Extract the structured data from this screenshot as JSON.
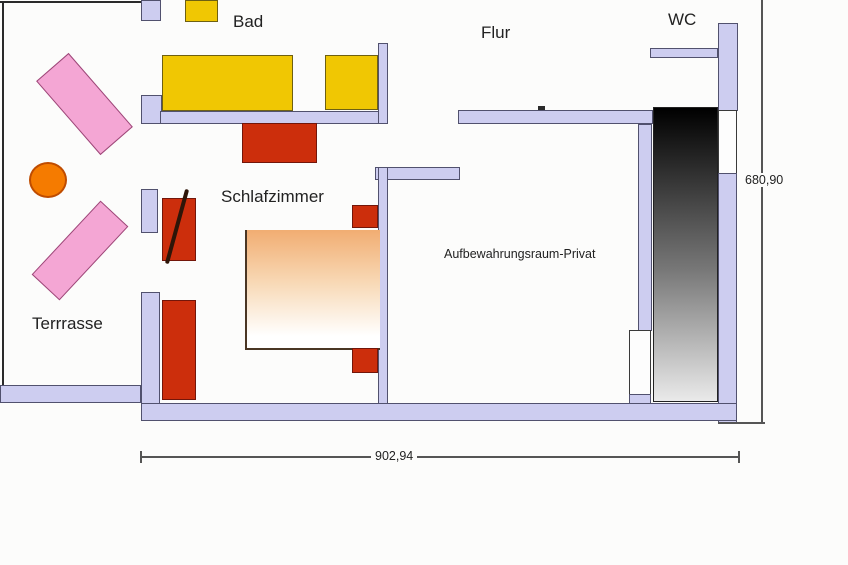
{
  "labels": {
    "bad": "Bad",
    "flur": "Flur",
    "wc": "WC",
    "schlafzimmer": "Schlafzimmer",
    "terrasse": "Terrrasse",
    "aufbewahrung": "Aufbewahrungsraum-Privat"
  },
  "dimensions": {
    "height_label": "680,90",
    "width_label": "902,94"
  },
  "colors": {
    "bg": "#fcfcfb",
    "text": "#222222",
    "wall": "#cdcdf0",
    "wall_border": "#51516e",
    "outline": "#2a2a2a",
    "yellow": "#f0c703",
    "yellow_border": "#6e6012",
    "red": "#cc2e0c",
    "red_border": "#73160a",
    "pink": "#f4a6d4",
    "pink_border": "#9c4878",
    "orange": "#f57b00",
    "orange_border": "#bf4c00",
    "bed_top": "#f1ad72",
    "bed_bottom": "#ffffff",
    "grad_top": "#000000",
    "grad_bottom": "#eaeaea",
    "door_white": "#fdfdfd",
    "dim_line": "#555555"
  }
}
